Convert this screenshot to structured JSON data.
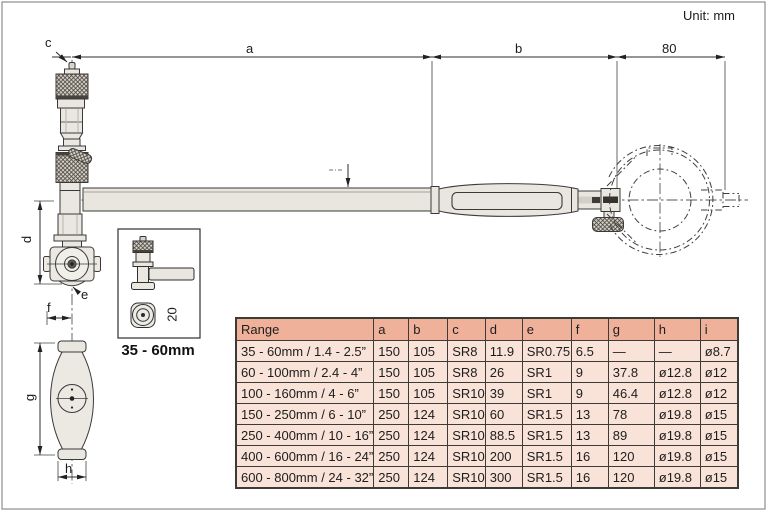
{
  "unit_label": "Unit: mm",
  "diagram": {
    "dim_a": "a",
    "dim_b": "b",
    "dim_c": "c",
    "dim_d": "d",
    "dim_e": "e",
    "dim_f": "f",
    "dim_g": "g",
    "dim_h": "h",
    "dim_80": "80",
    "dim_20": "20",
    "inset_caption": "35 - 60mm"
  },
  "table": {
    "headers": [
      "Range",
      "a",
      "b",
      "c",
      "d",
      "e",
      "f",
      "g",
      "h",
      "i"
    ],
    "rows": [
      [
        "35 - 60mm / 1.4 - 2.5”",
        "150",
        "105",
        "SR8",
        "11.9",
        "SR0.75",
        "6.5",
        "—",
        "—",
        "ø8.7"
      ],
      [
        "60 - 100mm / 2.4 - 4”",
        "150",
        "105",
        "SR8",
        "26",
        "SR1",
        "9",
        "37.8",
        "ø12.8",
        "ø12"
      ],
      [
        "100 - 160mm / 4 - 6”",
        "150",
        "105",
        "SR10",
        "39",
        "SR1",
        "9",
        "46.4",
        "ø12.8",
        "ø12"
      ],
      [
        "150 - 250mm / 6 - 10”",
        "250",
        "124",
        "SR10",
        "60",
        "SR1.5",
        "13",
        "78",
        "ø19.8",
        "ø15"
      ],
      [
        "250 - 400mm / 10 - 16”",
        "250",
        "124",
        "SR10",
        "88.5",
        "SR1.5",
        "13",
        "89",
        "ø19.8",
        "ø15"
      ],
      [
        "400 - 600mm / 16 - 24”",
        "250",
        "124",
        "SR10",
        "200",
        "SR1.5",
        "16",
        "120",
        "ø19.8",
        "ø15"
      ],
      [
        "600 - 800mm / 24 - 32”",
        "250",
        "124",
        "SR10",
        "300",
        "SR1.5",
        "16",
        "120",
        "ø19.8",
        "ø15"
      ]
    ]
  },
  "colors": {
    "table_header_bg": "#f0b19b",
    "table_row_bg": "#f9e3d8",
    "table_border": "#3d3b38",
    "line": "#3a3a3a"
  }
}
